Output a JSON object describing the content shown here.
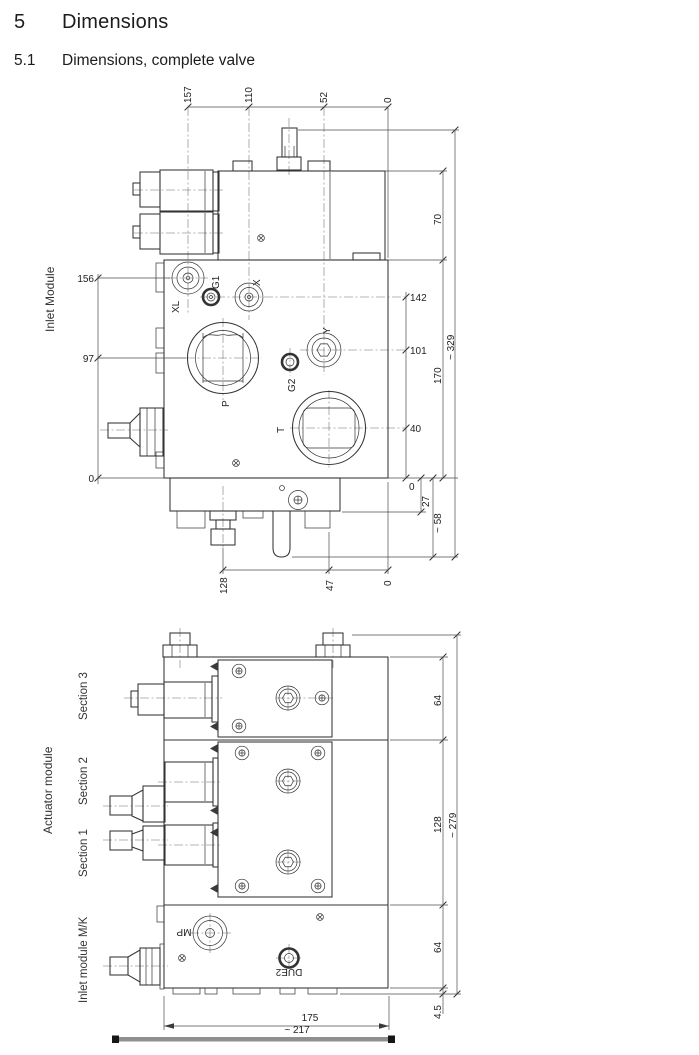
{
  "document": {
    "section_number": "5",
    "section_title": "Dimensions",
    "subsection_number": "5.1",
    "subsection_title": "Dimensions, complete valve"
  },
  "inlet_drawing": {
    "module_label": "Inlet Module",
    "ports": {
      "xl": "XL",
      "g1": "G1",
      "x": "X",
      "y": "Y",
      "g2": "G2",
      "p": "P",
      "t": "T"
    },
    "dim_top": [
      "157",
      "110",
      "52",
      "0"
    ],
    "dim_left": [
      "156",
      "97",
      "0"
    ],
    "dim_right_ports": [
      "142",
      "101",
      "40",
      "0"
    ],
    "dim_right_heights": {
      "pilot": "70",
      "body": "170",
      "overall": "~ 329",
      "lower": "27",
      "lower_overall": "~ 58"
    },
    "dim_bottom": [
      "128",
      "47",
      "0"
    ]
  },
  "actuator_drawing": {
    "module_label": "Actuator module",
    "sections": [
      "Section 3",
      "Section 2",
      "Section 1",
      "Inlet module M/K"
    ],
    "ports": {
      "mp": "MP",
      "due2": "DUE2"
    },
    "dim_right": {
      "section3": "64",
      "sections12": "128",
      "overall": "~ 279",
      "inlet": "64",
      "base": "4.5"
    },
    "dim_bottom": {
      "body": "175",
      "overall": "~ 217"
    }
  },
  "colors": {
    "line": "#333333",
    "dimension": "#4d4d4d",
    "text": "#222222",
    "baseplate": "#8f8f8f"
  }
}
